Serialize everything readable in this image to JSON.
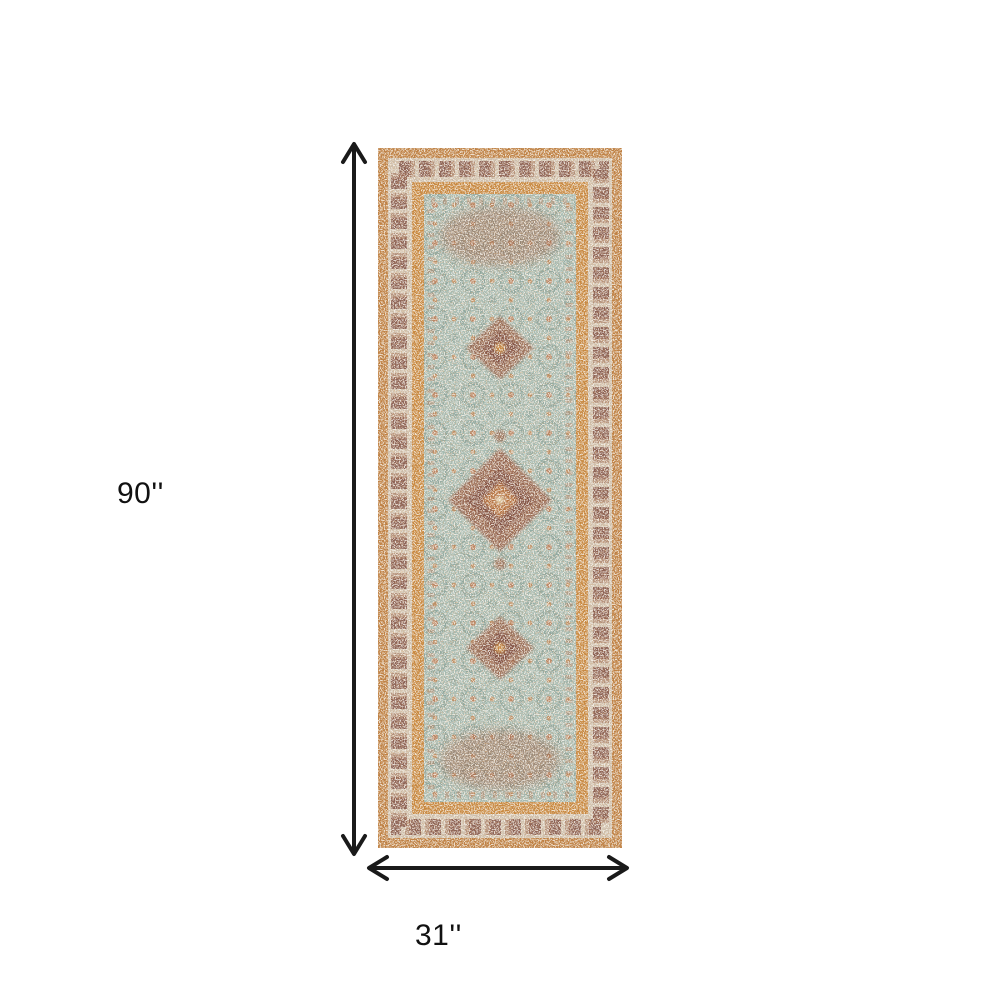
{
  "dimensions": {
    "height_label": "90''",
    "width_label": "31''"
  },
  "annotation": {
    "arrow_color": "#1a1a1a",
    "label_color": "#111111"
  },
  "rug": {
    "name": "distressed-vintage-runner-rug",
    "colors": {
      "outer_border_orange": "#bf8144",
      "border_band_light": "#cfc0ad",
      "border_band_dark": "#7c4b40",
      "guard_stripe_orange": "#c8883f",
      "field_teal": "#a6bbb2",
      "medallion_rust": "#96614a",
      "medallion_inner_dark": "#7c4b40",
      "accent_orange": "#c07a43"
    }
  }
}
